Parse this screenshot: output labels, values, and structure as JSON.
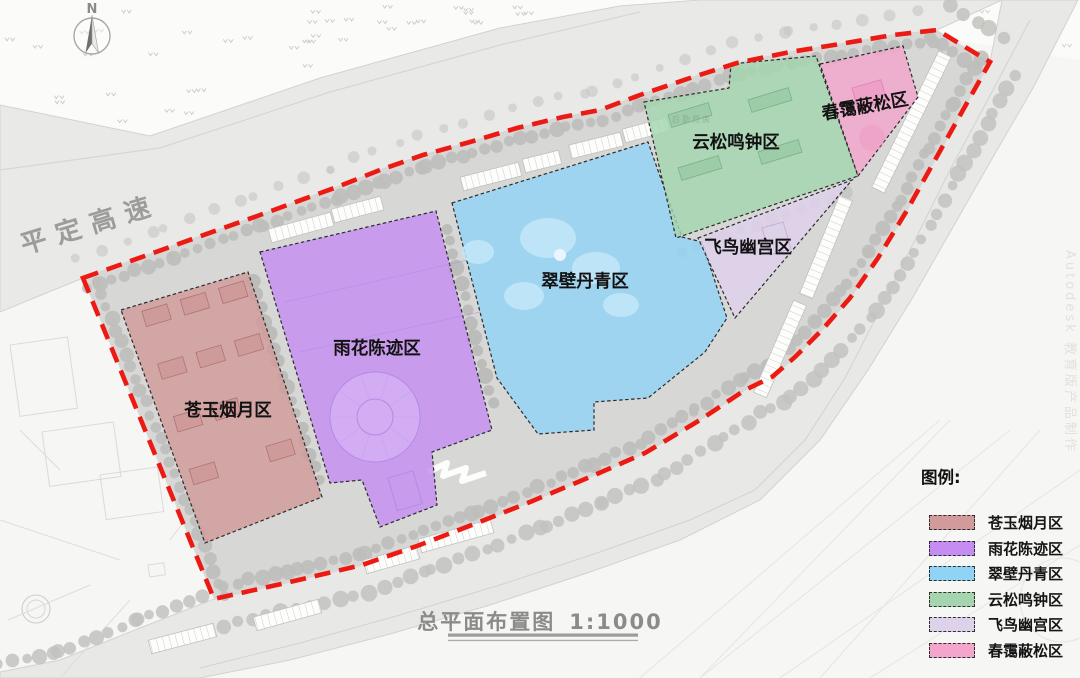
{
  "map": {
    "compass_label": "N",
    "road_label": "平定高速",
    "plan_title": "总平面布置图",
    "plan_scale": "1:1000",
    "legend_title": "图例:",
    "site_annotation": "后勤用房",
    "watermark": "Autodesk 教育版产品制作",
    "boundary_color": "#ec1a12",
    "zones": [
      {
        "id": "cangyu",
        "name": "苍玉烟月区",
        "color": "#d29b9b"
      },
      {
        "id": "yuhua",
        "name": "雨花陈迹区",
        "color": "#c58df1"
      },
      {
        "id": "cuibi",
        "name": "翠壁丹青区",
        "color": "#91d3f4"
      },
      {
        "id": "yunsong",
        "name": "云松鸣钟区",
        "color": "#a4d5ae"
      },
      {
        "id": "feiniao",
        "name": "飞鸟幽宫区",
        "color": "#ded1ea"
      },
      {
        "id": "chunai",
        "name": "春霭蔽松区",
        "color": "#f3a5cc"
      }
    ]
  }
}
